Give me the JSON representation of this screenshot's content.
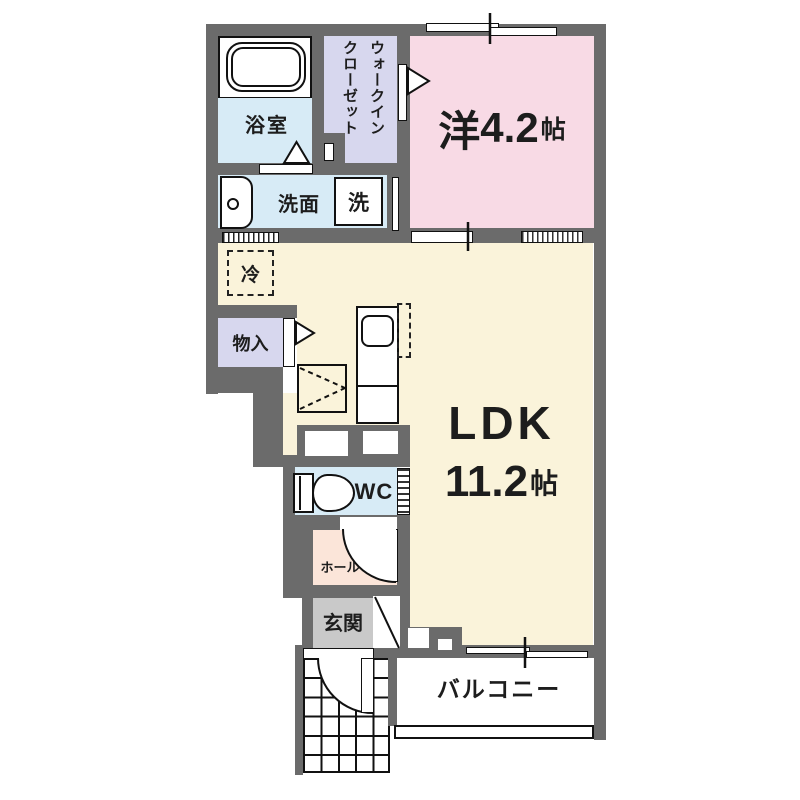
{
  "plan": {
    "rooms": {
      "bathroom": {
        "name": "浴室"
      },
      "walkin_closet": {
        "name": "ウォークインクローゼット",
        "line1": "ウォークイン",
        "line2": "クローゼット"
      },
      "western_room": {
        "name": "洋",
        "size": "4.2",
        "unit": "帖"
      },
      "washroom": {
        "name": "洗面"
      },
      "washer": {
        "name": "洗"
      },
      "refrigerator": {
        "name": "冷"
      },
      "storage": {
        "name": "物入"
      },
      "ldk": {
        "name": "LDK",
        "size": "11.2",
        "unit": "帖"
      },
      "wc": {
        "name": "WC"
      },
      "hall": {
        "name": "ホール"
      },
      "entrance": {
        "name": "玄関"
      },
      "balcony": {
        "name": "バルコニー"
      }
    },
    "colors": {
      "wall": "#6b6b6b",
      "water_rooms": "#d7ebf6",
      "closet": "#d7d7ee",
      "western_room": "#f8dae5",
      "ldk": "#faf3da",
      "hall": "#fbe5d9",
      "entrance": "#c9c9c9"
    }
  }
}
